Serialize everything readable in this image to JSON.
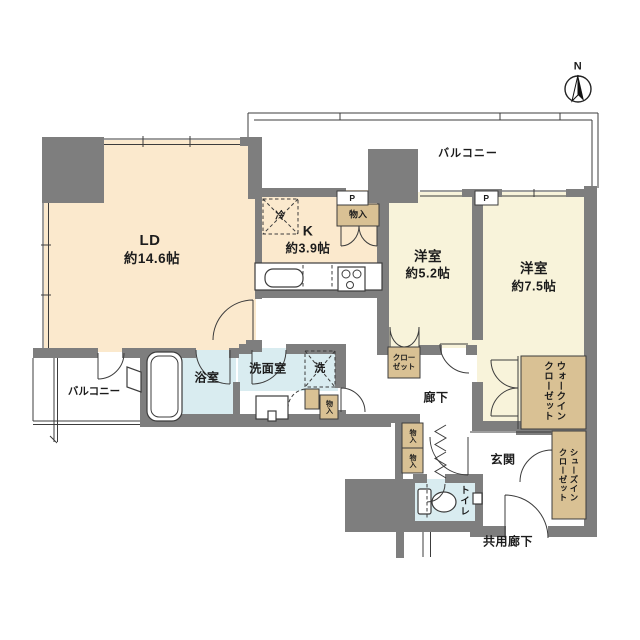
{
  "colors": {
    "wall": "#7e7e7e",
    "line": "#3c3c3c",
    "ld": "#fbe9cd",
    "bedroom": "#f8f3da",
    "closet": "#d9c194",
    "wet": "#d9ecf0"
  },
  "compass": {
    "north_label": "N"
  },
  "labels": {
    "storage": "物入",
    "pipe": "P",
    "fridge": "冷",
    "washer": "洗"
  },
  "rooms": {
    "living_dining": {
      "name": "LD",
      "size": "約14.6帖"
    },
    "kitchen": {
      "name": "K",
      "size": "約3.9帖"
    },
    "bedroom_52": {
      "name": "洋室",
      "size": "約5.2帖",
      "closet": "クロー\nゼット"
    },
    "bedroom_75": {
      "name": "洋室",
      "size": "約7.5帖",
      "walk_in_closet": "ウォークイン\nクローゼット"
    },
    "bath": {
      "name": "浴室"
    },
    "washroom": {
      "name": "洗面室"
    },
    "toilet": {
      "name": "トイレ"
    },
    "hallway": {
      "name": "廊下"
    },
    "entrance": {
      "name": "玄関",
      "shoes_in_closet": "シューズイン\nクローゼット"
    },
    "balcony_top": {
      "name": "バルコニー"
    },
    "balcony_left": {
      "name": "バルコニー"
    },
    "common_hallway": {
      "name": "共用廊下"
    }
  }
}
